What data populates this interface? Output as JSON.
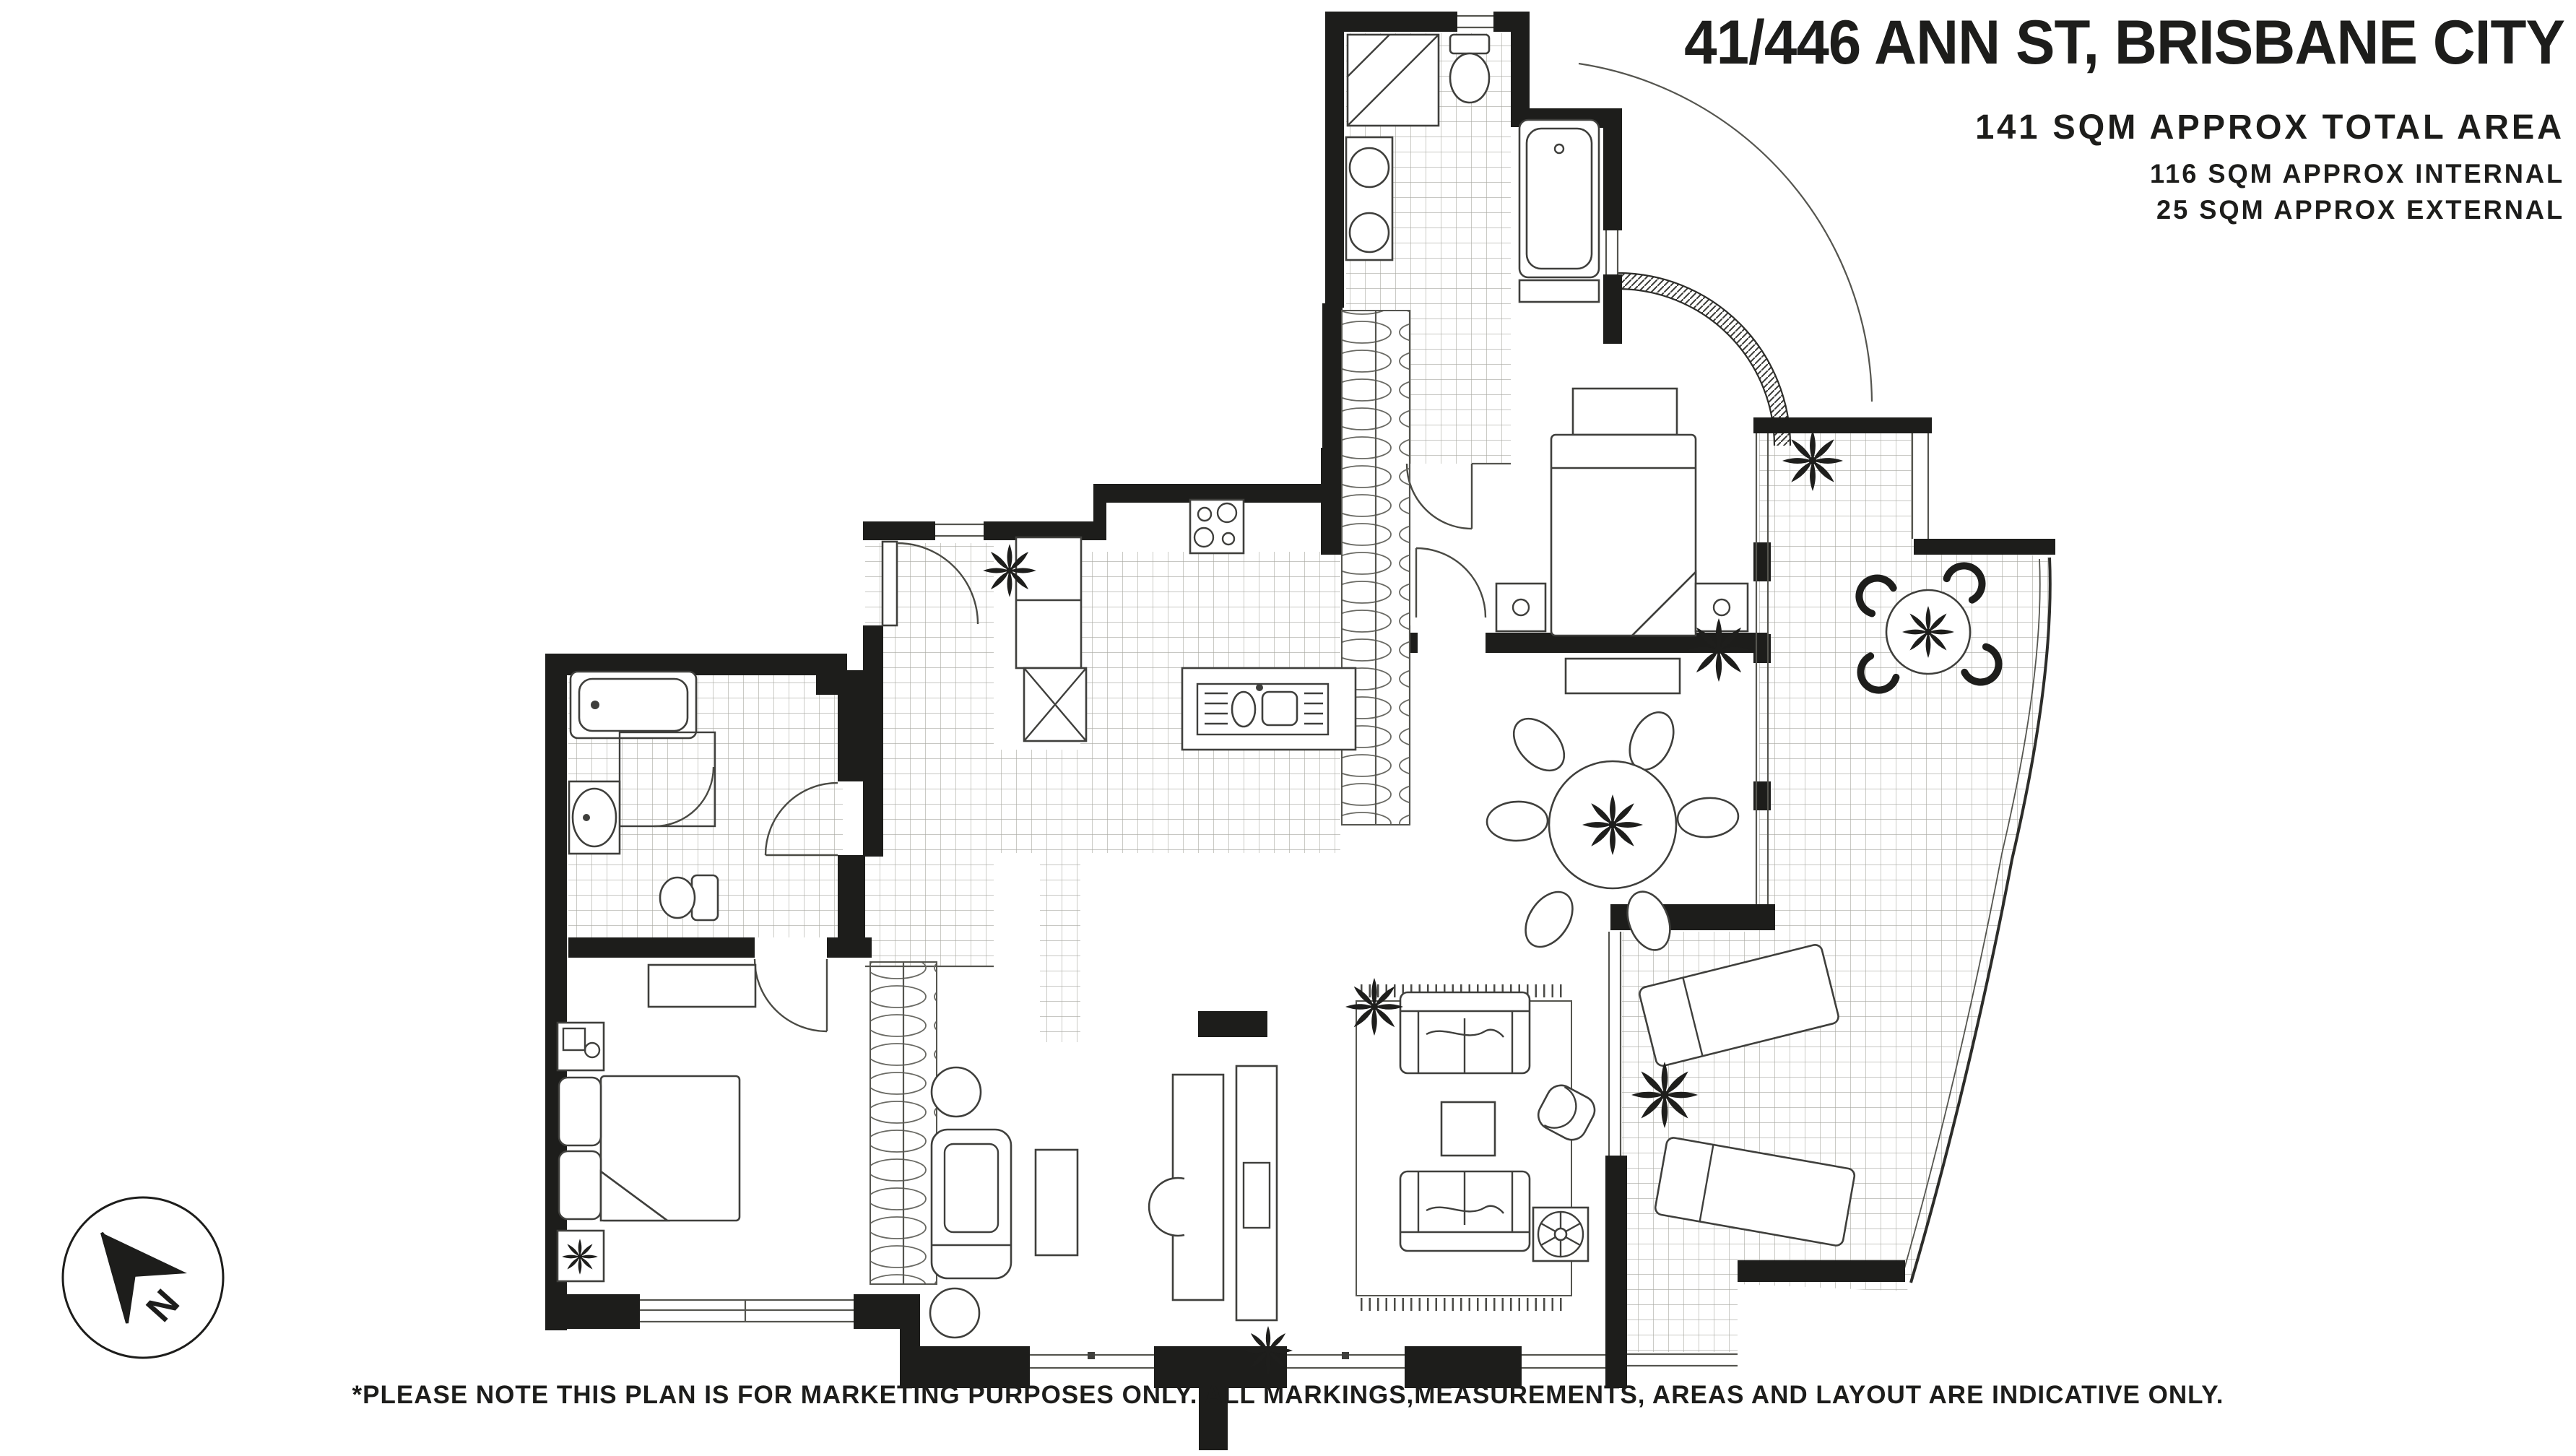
{
  "header": {
    "title": "41/446 ANN ST, BRISBANE CITY",
    "area_total": "141 SQM APPROX TOTAL AREA",
    "area_internal": "116 SQM APPROX INTERNAL",
    "area_external": "25 SQM APPROX EXTERNAL"
  },
  "footer": {
    "disclaimer": "*PLEASE NOTE THIS PLAN IS FOR MARKETING PURPOSES ONLY. ALL MARKINGS,MEASUREMENTS, AREAS AND LAYOUT ARE INDICATIVE ONLY."
  },
  "compass": {
    "label": "N"
  },
  "colors": {
    "wall": "#1d1d1b",
    "furniture_line": "#3f3f3c",
    "tile_line": "#a8a8a0",
    "background": "#ffffff"
  },
  "plan": {
    "type": "residential-apartment-floor-plan",
    "features": [
      "north-arrow-compass",
      "ensuite-shower",
      "ensuite-toilet",
      "ensuite-twin-basins",
      "ensuite-bathtub",
      "master-bed",
      "master-bedside-tables",
      "master-wardrobe",
      "entry-door",
      "entry-hall-tiles",
      "kitchen-cooktop",
      "kitchen-island-double-sink",
      "kitchen-pantry-unit",
      "bathroom-bathtub",
      "bathroom-shower",
      "bathroom-basin",
      "bathroom-toilet",
      "bedroom2-bed",
      "bedroom2-bedside-tables",
      "bedroom2-dresser",
      "bedroom2-wardrobe",
      "study-desk",
      "study-chair",
      "study-armchair",
      "study-side-tables",
      "study-coffee-table",
      "living-sofa-pair",
      "living-coffee-table",
      "living-armchair",
      "living-fan-table",
      "living-rug",
      "dining-round-table-six-chairs",
      "terrace-outdoor-table-four-chairs",
      "terrace-sun-loungers",
      "potted-plants",
      "curved-glazed-wall",
      "curved-terrace-edge",
      "tiled-terrace"
    ]
  }
}
